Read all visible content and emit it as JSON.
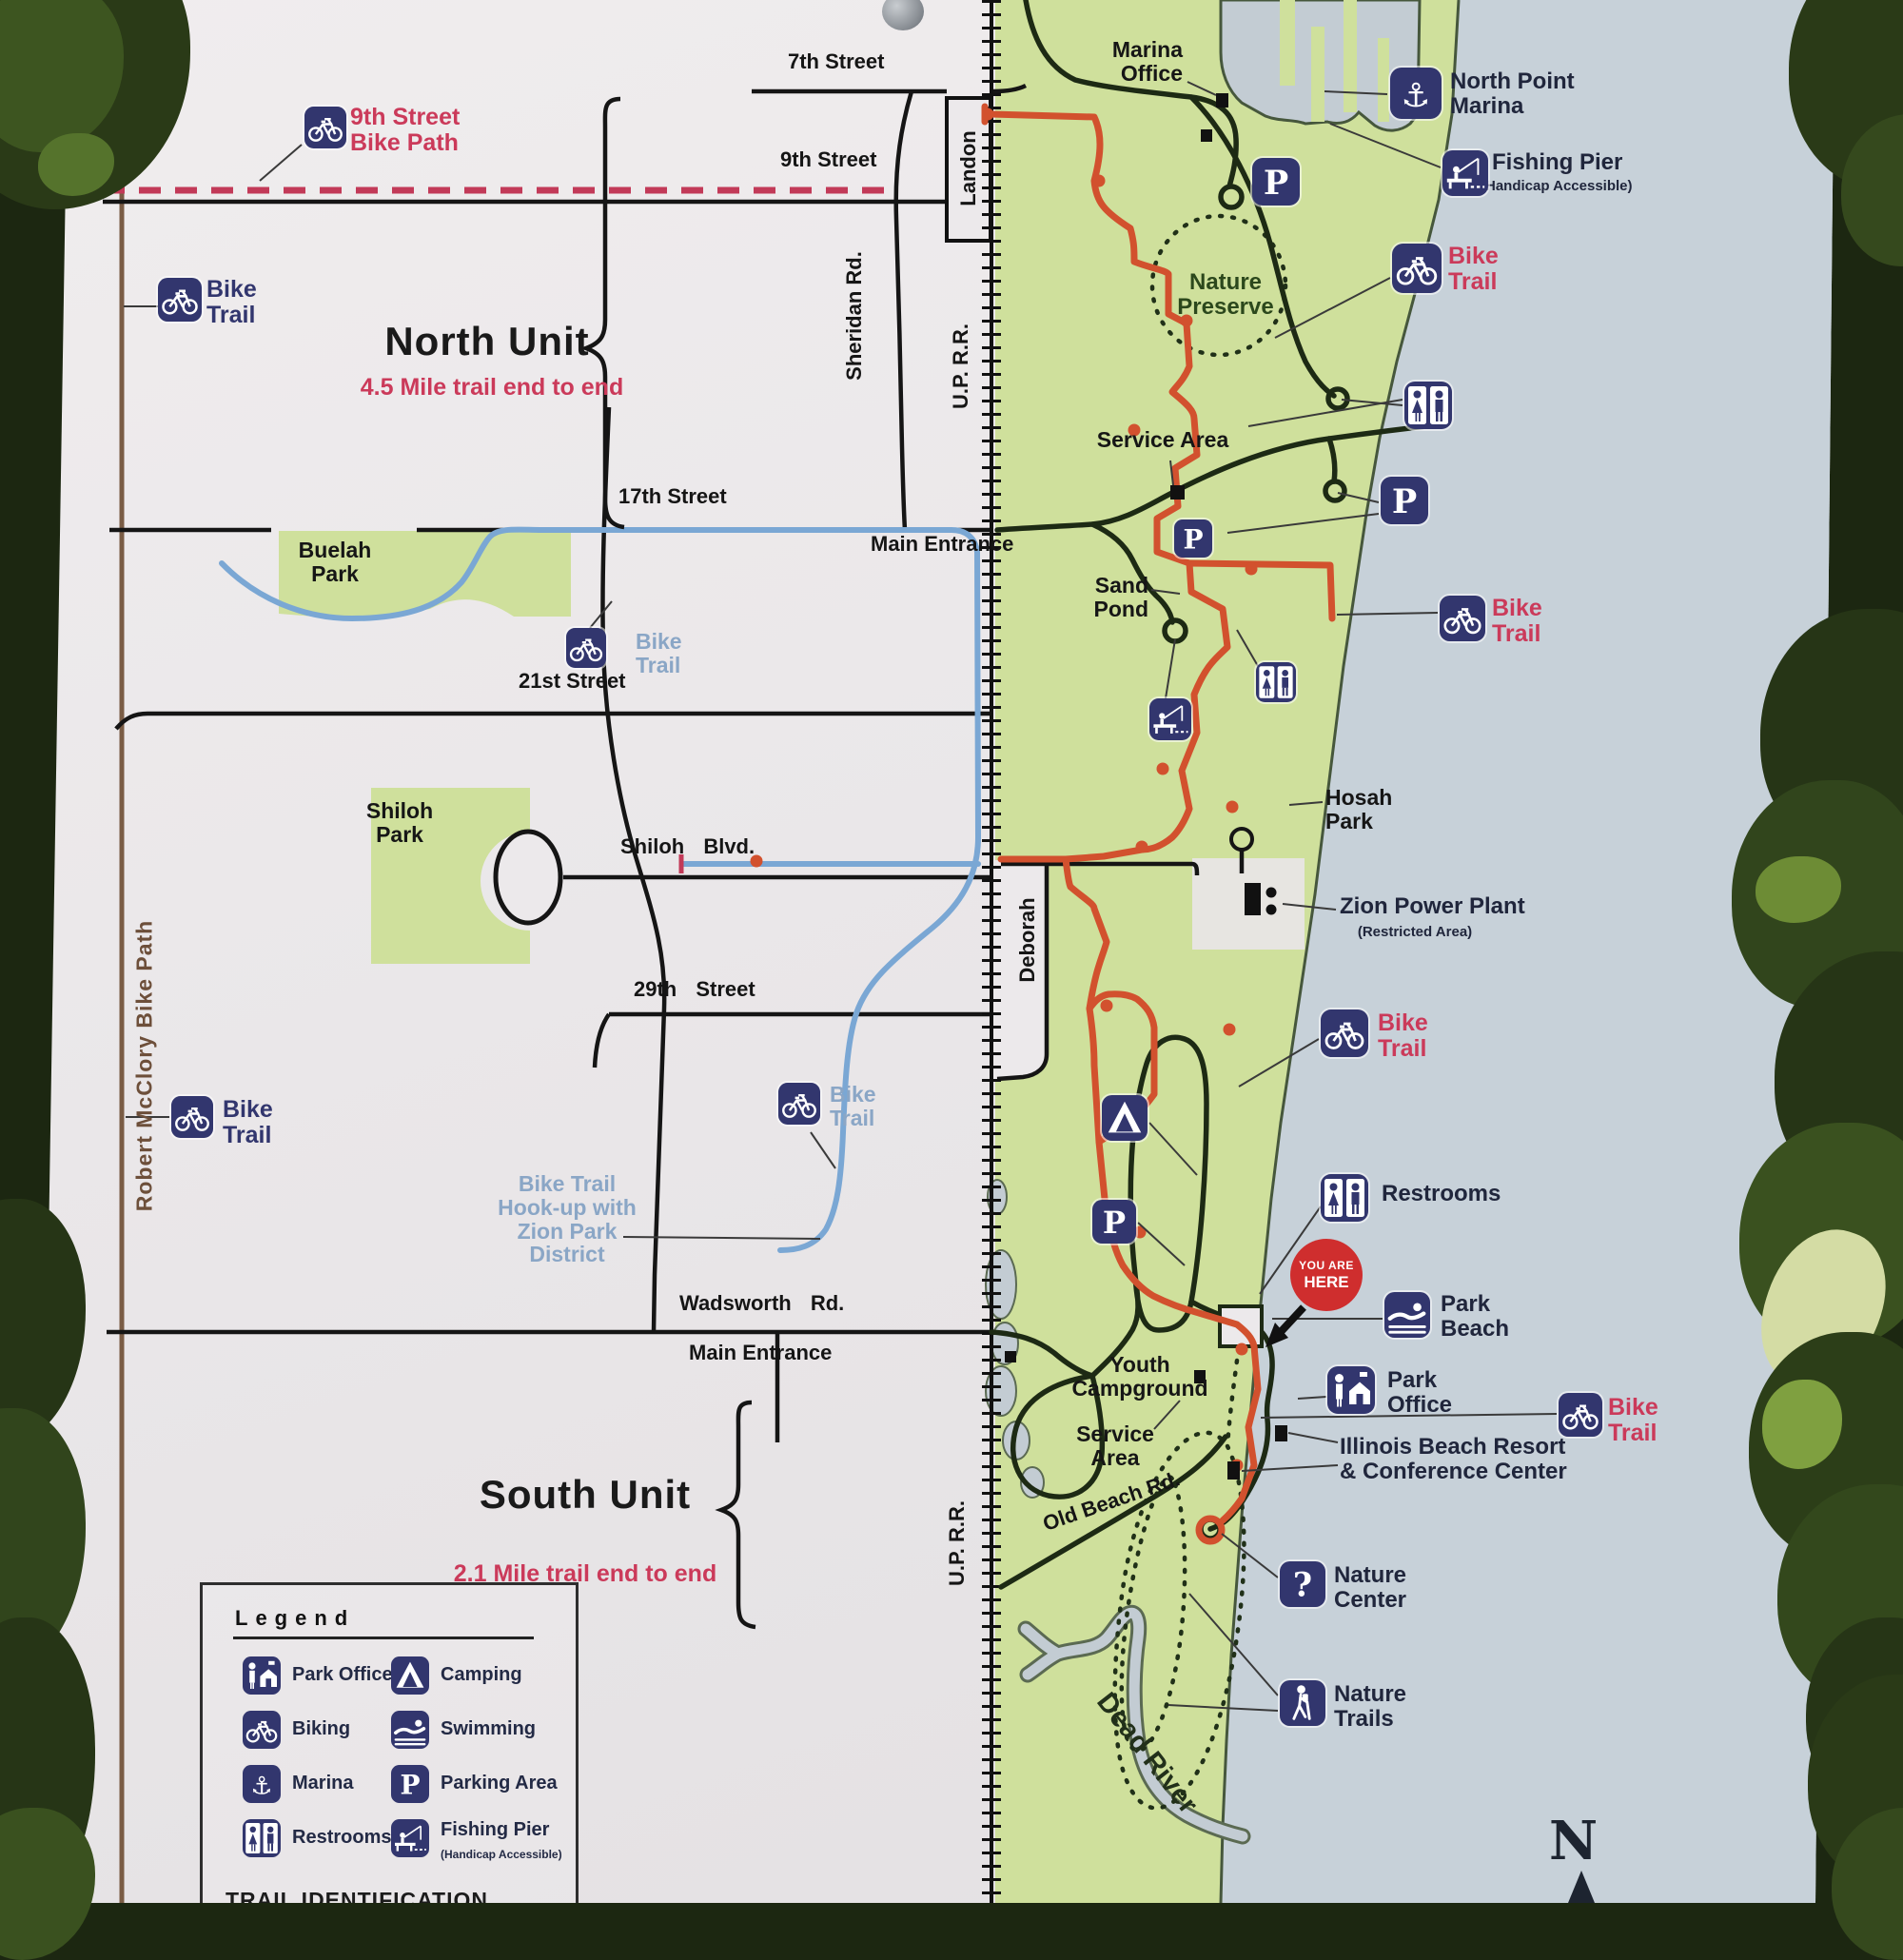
{
  "colors": {
    "sign": "#ece9eb",
    "park": "#cfe09c",
    "lake": "#c7d1d9",
    "water": "#c3ccd3",
    "road": "#151515",
    "parkroad": "#1d2a14",
    "trail_red": "#d2512e",
    "dashed_red": "#c23a58",
    "label_red": "#cb3a5a",
    "navy": "#32366e",
    "lightblue": "#8aa6c6",
    "brown": "#7a5c45",
    "foliage": "#1c2711"
  },
  "map": {
    "labels": [
      {
        "id": "street-7th",
        "cls": "street",
        "lines": [
          "7th Street"
        ]
      },
      {
        "id": "street-9th",
        "cls": "street",
        "lines": [
          "9th Street"
        ]
      },
      {
        "id": "street-17th",
        "cls": "street",
        "lines": [
          "17th Street"
        ]
      },
      {
        "id": "street-21st",
        "cls": "street",
        "lines": [
          "21st Street"
        ]
      },
      {
        "id": "street-shiloh",
        "cls": "street sp",
        "lines": [
          "Shiloh Blvd."
        ]
      },
      {
        "id": "street-29th",
        "cls": "street sp",
        "lines": [
          "29th Street"
        ]
      },
      {
        "id": "street-wadsworth",
        "cls": "street sp",
        "lines": [
          "Wadsworth Rd."
        ]
      },
      {
        "id": "main-entrance-north",
        "cls": "street",
        "lines": [
          "Main Entrance"
        ]
      },
      {
        "id": "main-entrance-south",
        "cls": "street",
        "lines": [
          "Main Entrance"
        ]
      },
      {
        "id": "street-sheridan",
        "cls": "street",
        "lines": [
          "Sheridan Rd."
        ]
      },
      {
        "id": "street-landon",
        "cls": "street",
        "lines": [
          "Landon"
        ]
      },
      {
        "id": "uprr-north",
        "cls": "street",
        "lines": [
          "U.P. R.R."
        ]
      },
      {
        "id": "uprr-south",
        "cls": "street",
        "lines": [
          "U.P. R.R."
        ]
      },
      {
        "id": "street-deborah",
        "cls": "street",
        "lines": [
          "Deborah"
        ]
      },
      {
        "id": "robert-mcclory-bike-path",
        "cls": "mcclory",
        "lines": [
          "Robert McClory Bike Path"
        ]
      },
      {
        "id": "north-unit-title",
        "cls": "unit",
        "lines": [
          "North Unit"
        ]
      },
      {
        "id": "north-unit-sub",
        "cls": "unit-sub",
        "lines": [
          "4.5 Mile trail end to end"
        ]
      },
      {
        "id": "south-unit-title",
        "cls": "unit",
        "lines": [
          "South Unit"
        ]
      },
      {
        "id": "south-unit-sub",
        "cls": "unit-sub",
        "lines": [
          "2.1 Mile trail end to end"
        ]
      },
      {
        "id": "ninth-street-bike-path",
        "cls": "red-label",
        "lines": [
          "9th Street",
          "Bike Path"
        ]
      },
      {
        "id": "bike-trail-northwest",
        "cls": "navy-label",
        "lines": [
          "Bike",
          "Trail"
        ]
      },
      {
        "id": "bike-trail-southwest",
        "cls": "navy-label",
        "lines": [
          "Bike",
          "Trail"
        ]
      },
      {
        "id": "bike-trail-buelah",
        "cls": "lblue-label",
        "lines": [
          "Bike",
          "Trail"
        ]
      },
      {
        "id": "bike-trail-wadsworth",
        "cls": "lblue-label",
        "lines": [
          "Bike",
          "Trail"
        ]
      },
      {
        "id": "bike-trail-northeast",
        "cls": "red-label",
        "lines": [
          "Bike",
          "Trail"
        ]
      },
      {
        "id": "bike-trail-mid",
        "cls": "red-label",
        "lines": [
          "Bike",
          "Trail"
        ]
      },
      {
        "id": "bike-trail-south",
        "cls": "red-label",
        "lines": [
          "Bike",
          "Trail"
        ]
      },
      {
        "id": "bike-trail-far-right",
        "cls": "red-label",
        "lines": [
          "Bike",
          "Trail"
        ]
      },
      {
        "id": "marina-office",
        "cls": "poi-black",
        "lines": [
          "Marina",
          "Office"
        ]
      },
      {
        "id": "north-point-marina",
        "cls": "poi",
        "lines": [
          "North Point",
          "Marina"
        ]
      },
      {
        "id": "fishing-pier-label",
        "cls": "poi",
        "lines": [
          "Fishing Pier"
        ]
      },
      {
        "id": "fishing-pier-sub",
        "cls": "poi-small",
        "lines": [
          "(Handicap Accessible)"
        ]
      },
      {
        "id": "nature-preserve",
        "cls": "green-label",
        "lines": [
          "Nature",
          "Preserve"
        ]
      },
      {
        "id": "service-area-north",
        "cls": "poi-black",
        "lines": [
          "Service Area"
        ]
      },
      {
        "id": "sand-pond",
        "cls": "poi-black",
        "lines": [
          "Sand",
          "Pond"
        ]
      },
      {
        "id": "hosah-park",
        "cls": "poi-black",
        "lines": [
          "Hosah",
          "Park"
        ]
      },
      {
        "id": "zion-power-plant",
        "cls": "poi",
        "lines": [
          "Zion Power Plant"
        ]
      },
      {
        "id": "zion-power-plant-sub",
        "cls": "poi-small",
        "lines": [
          "(Restricted Area)"
        ]
      },
      {
        "id": "buelah-park",
        "cls": "poi-black",
        "lines": [
          "Buelah",
          "Park"
        ]
      },
      {
        "id": "shiloh-park",
        "cls": "poi-black",
        "lines": [
          "Shiloh",
          "Park"
        ]
      },
      {
        "id": "bike-trail-hookup",
        "cls": "lblue-label",
        "lines": [
          "Bike Trail",
          "Hook-up with",
          "Zion Park",
          "District"
        ]
      },
      {
        "id": "youth-campground",
        "cls": "poi-black",
        "lines": [
          "Youth",
          "Campground"
        ]
      },
      {
        "id": "service-area-south",
        "cls": "poi-black",
        "lines": [
          "Service",
          "Area"
        ]
      },
      {
        "id": "restrooms-label",
        "cls": "poi",
        "lines": [
          "Restrooms"
        ]
      },
      {
        "id": "park-beach",
        "cls": "poi",
        "lines": [
          "Park",
          "Beach"
        ]
      },
      {
        "id": "park-office-label",
        "cls": "poi",
        "lines": [
          "Park",
          "Office"
        ]
      },
      {
        "id": "illinois-beach-resort",
        "cls": "poi",
        "lines": [
          "Illinois Beach Resort",
          "& Conference Center"
        ]
      },
      {
        "id": "nature-center-label",
        "cls": "poi",
        "lines": [
          "Nature",
          "Center"
        ]
      },
      {
        "id": "nature-trails-label",
        "cls": "poi",
        "lines": [
          "Nature",
          "Trails"
        ]
      },
      {
        "id": "old-beach-rd",
        "cls": "street",
        "lines": [
          "Old Beach Rd."
        ]
      },
      {
        "id": "dead-river",
        "cls": "river-label",
        "lines": [
          "Dead River"
        ]
      }
    ],
    "icons": [
      {
        "id": "bike-9th",
        "type": "bike"
      },
      {
        "id": "bike-northwest",
        "type": "bike"
      },
      {
        "id": "bike-buelah",
        "type": "bike"
      },
      {
        "id": "bike-southwest",
        "type": "bike"
      },
      {
        "id": "bike-wadsworth",
        "type": "bike"
      },
      {
        "id": "bike-northeast",
        "type": "bike"
      },
      {
        "id": "bike-mid",
        "type": "bike"
      },
      {
        "id": "bike-south",
        "type": "bike"
      },
      {
        "id": "bike-far-right",
        "type": "bike"
      },
      {
        "id": "anchor-marina",
        "type": "anchor"
      },
      {
        "id": "fishing-pier-ne",
        "type": "fishing"
      },
      {
        "id": "restrooms-north",
        "type": "restroom"
      },
      {
        "id": "parking-north",
        "type": "parking"
      },
      {
        "id": "parking-marina",
        "type": "parking"
      },
      {
        "id": "parking-pond",
        "type": "parking"
      },
      {
        "id": "restrooms-pond",
        "type": "restroom"
      },
      {
        "id": "fishing-pond",
        "type": "fishing"
      },
      {
        "id": "camping-area",
        "type": "camping"
      },
      {
        "id": "parking-campground",
        "type": "parking"
      },
      {
        "id": "restrooms-southeast",
        "type": "restroom"
      },
      {
        "id": "swimming-beach",
        "type": "swimming"
      },
      {
        "id": "park-office-icon",
        "type": "parkoffice"
      },
      {
        "id": "nature-center-icon",
        "type": "question"
      },
      {
        "id": "nature-trails-icon",
        "type": "hiker"
      }
    ],
    "you_are_here": {
      "line1": "YOU ARE",
      "line2": "HERE"
    },
    "compass": "N"
  },
  "legend": {
    "title": "Legend",
    "items": [
      {
        "icon": "parkoffice",
        "name": "park-offices-icon",
        "label": "Park Offices"
      },
      {
        "icon": "camping",
        "name": "camping-icon",
        "label": "Camping"
      },
      {
        "icon": "bike",
        "name": "biking-icon",
        "label": "Biking"
      },
      {
        "icon": "swimming",
        "name": "swimming-icon",
        "label": "Swimming"
      },
      {
        "icon": "anchor",
        "name": "marina-icon",
        "label": "Marina"
      },
      {
        "icon": "parking",
        "name": "parking-area-icon",
        "label": "Parking Area"
      },
      {
        "icon": "restroom",
        "name": "restrooms-icon",
        "label": "Restrooms"
      },
      {
        "icon": "fishing",
        "name": "fishing-pier-icon",
        "label": "Fishing Pier",
        "sublabel": "(Handicap Accessible)"
      }
    ],
    "footer": "TRAIL IDENTIFICATION"
  }
}
